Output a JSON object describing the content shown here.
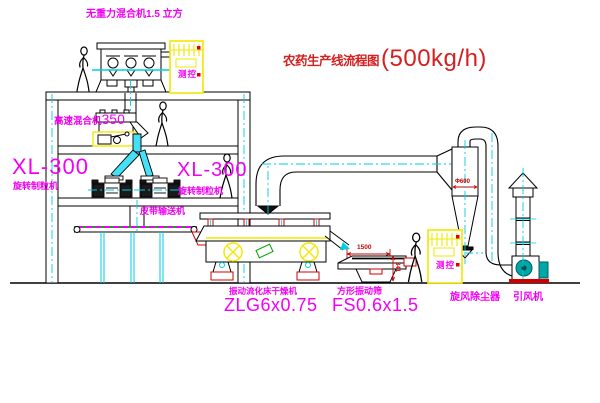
{
  "title": {
    "cn": "农药生产线流程图",
    "capacity": "(500kg/h)"
  },
  "labels": {
    "top_mixer": "无重力混合机1.5 立方",
    "high_speed_mixer_name": "高速混合机",
    "high_speed_mixer_size": "350",
    "xl300_left": "XL-300",
    "granulator_left": "旋转制粒机",
    "xl300_right": "XL-300",
    "granulator_right": "旋转制粒机",
    "belt_conveyor": "皮带输送机",
    "dryer_name": "振动流化床干燥机",
    "dryer_model": "ZLG6x0.75",
    "sieve_name": "方形振动筛",
    "sieve_model": "FS0.6x1.5",
    "cyclone": "旋风除尘器",
    "fan": "引风机",
    "cabinet_1": "测控",
    "cabinet_2": "测控"
  },
  "dimensions": {
    "sieve_width": "1500",
    "sieve_base_height": "341",
    "cyclone_diameter": "Φ600"
  },
  "colors": {
    "label_magenta": "#f200f2",
    "title_red": "#d42020",
    "dim_red": "#cf0000",
    "centerline_cyan": "#00cfe4",
    "cabinet_yellow": "#f2e800",
    "fan_teal": "#00a5a5",
    "conveyor_green": "#00b400",
    "line_black": "#000000"
  }
}
